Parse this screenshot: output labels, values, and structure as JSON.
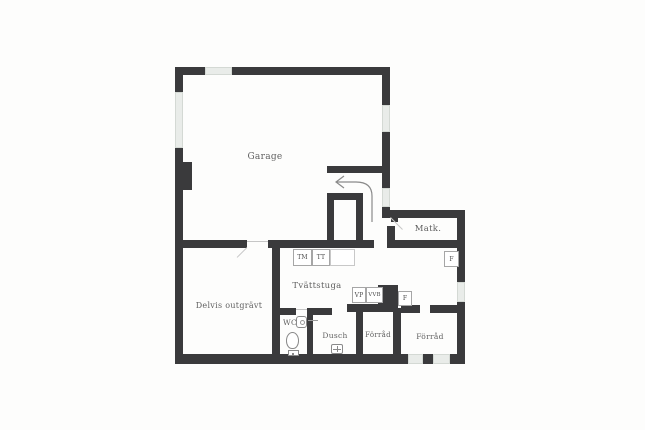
{
  "plan": {
    "type": "floor-plan",
    "colors": {
      "wall": "#3a3a3c",
      "window": "#e9ece9",
      "background": "#fdfdfc",
      "label": "#5f5f5f",
      "icon_stroke": "#8a8a8a"
    },
    "rooms": {
      "garage": {
        "label": "Garage"
      },
      "matk": {
        "label": "Matk."
      },
      "tvattstuga": {
        "label": "Tvättstuga"
      },
      "delvis": {
        "label": "Delvis outgrävt"
      },
      "wc": {
        "label": "WC"
      },
      "dusch": {
        "label": "Dusch"
      },
      "forrad1": {
        "label": "Förråd"
      },
      "forrad2": {
        "label": "Förråd"
      }
    },
    "fixtures": {
      "tm": {
        "label": "TM"
      },
      "tt": {
        "label": "TT"
      },
      "vp": {
        "label": "VP"
      },
      "vvb": {
        "label": "VVB"
      },
      "f1": {
        "label": "F"
      },
      "f2": {
        "label": "F"
      }
    },
    "icons": {
      "direction_arrow": "curved-left-arrow",
      "toilet": "toilet-top-view",
      "sink": "wash-basin",
      "floor_drain": "floor-drain-cross"
    }
  }
}
